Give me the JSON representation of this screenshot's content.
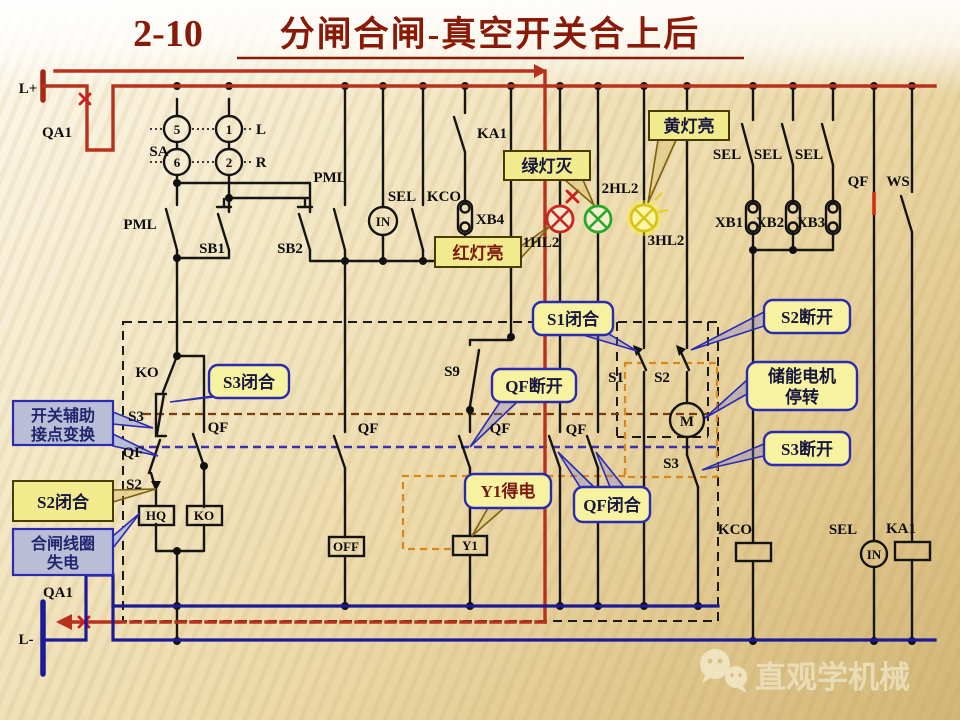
{
  "title": {
    "number": "2-10",
    "text": "分闸合闸-真空开关合上后"
  },
  "power": {
    "positive": "L+",
    "negative": "L-",
    "breaker": "QA1"
  },
  "labels": {
    "qa1": "QA1",
    "l_plus": "L+",
    "l_minus": "L-",
    "sa": "SA",
    "n5": "5",
    "n6": "6",
    "n1": "1",
    "n2": "2",
    "l": "L",
    "r": "R",
    "pml": "PML",
    "sb1": "SB1",
    "sb2": "SB2",
    "sel": "SEL",
    "kco": "KCO",
    "in": "IN",
    "ka1": "KA1",
    "xb1": "XB1",
    "xb2": "XB2",
    "xb3": "XB3",
    "xb4": "XB4",
    "hl1": "1HL2",
    "hl2": "2HL2",
    "hl3": "3HL2",
    "qf": "QF",
    "ws": "WS",
    "s9": "S9",
    "ko": "KO",
    "s1": "S1",
    "s2": "S2",
    "s3": "S3",
    "m": "M",
    "hq": "HQ",
    "off": "OFF",
    "y1": "Y1"
  },
  "callouts": {
    "red_lamp_on": "红灯亮",
    "green_lamp_off": "绿灯灭",
    "yellow_lamp_on": "黄灯亮",
    "s1_closed": "S1闭合",
    "s2_open": "S2断开",
    "motor_stop_line1": "储能电机",
    "motor_stop_line2": "停转",
    "s3_open": "S3断开",
    "qf_open": "QF断开",
    "qf_closed": "QF闭合",
    "s3_closed": "S3闭合",
    "aux_contact_line1": "开关辅助",
    "aux_contact_line2": "接点变换",
    "s2_closed": "S2闭合",
    "closing_coil_line1": "合闸线圈",
    "closing_coil_line2": "失电",
    "y1_energized": "Y1得电"
  },
  "watermark": {
    "brand": "直观学机械"
  },
  "colors": {
    "bus_positive": "#b8311c",
    "bus_negative": "#1c1a96",
    "lamp_red": "#cc2222",
    "lamp_green": "#28a828",
    "lamp_yellow": "#e8d820",
    "callout_yellow": "#f7f2a0",
    "callout_gray": "#b9bdd6",
    "callout_border": "#2b2bb0",
    "title": "#8a1a08"
  }
}
